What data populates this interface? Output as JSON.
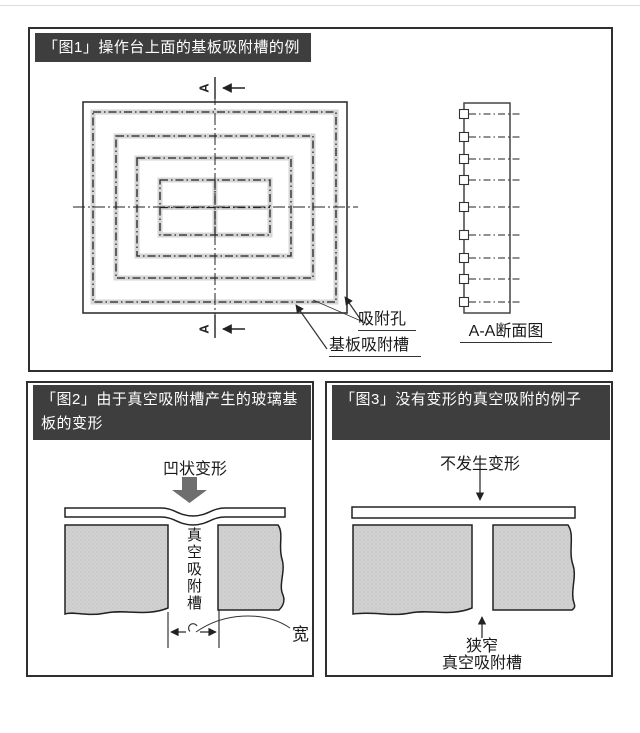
{
  "page": {
    "background": "#ffffff"
  },
  "colors": {
    "title_bar_bg": "#3e3e3e",
    "title_text": "#ffffff",
    "panel_border": "#2f2f2f",
    "line": "#222222",
    "groove_band_gray": "#d6d6d6",
    "block_gray": "#d1d1d1",
    "big_arrow_gray": "#6e6e6e"
  },
  "fig1": {
    "title": "「图1」操作台上面的基板吸附槽的例子",
    "section_letter": "A",
    "label_hole": "吸附孔",
    "label_groove": "基板吸附槽",
    "label_section_view": "A-A断面图"
  },
  "fig2": {
    "title": "「图2」由于真空吸附槽产生的玻璃基板的变形",
    "label_deform": "凹状变形",
    "label_groove": "真空吸附槽",
    "label_width": "宽"
  },
  "fig3": {
    "title": "「图3」没有变形的真空吸附的例子",
    "label_no_deform": "不发生变形",
    "label_narrow": "狭窄",
    "label_groove": "真空吸附槽"
  }
}
